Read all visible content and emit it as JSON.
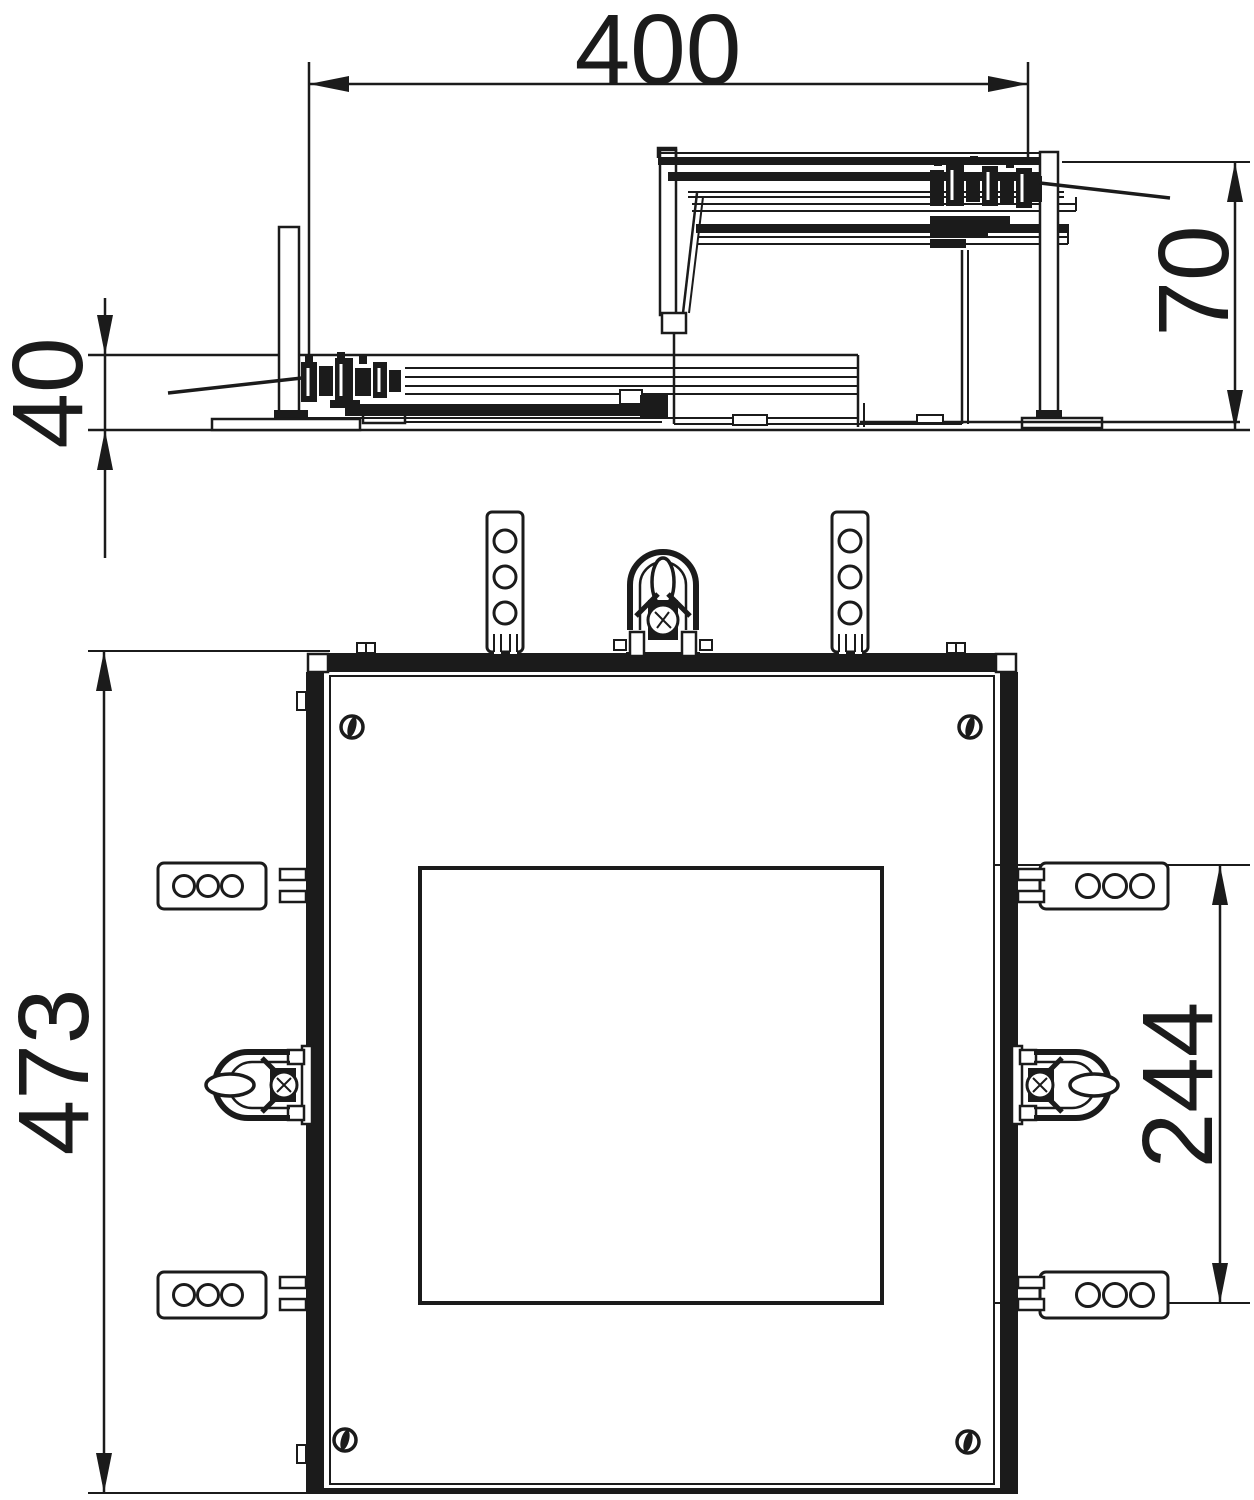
{
  "page": {
    "background": "#ffffff",
    "line_color": "#1b1b1b",
    "drawing_type": "floor-box installation drawing, side section and plan view"
  },
  "side_view": {
    "width_dim": "400",
    "height_max_dim": "70",
    "height_min_dim": "40"
  },
  "plan_view": {
    "overall_length_dim": "473",
    "cutout_length_dim": "244"
  }
}
